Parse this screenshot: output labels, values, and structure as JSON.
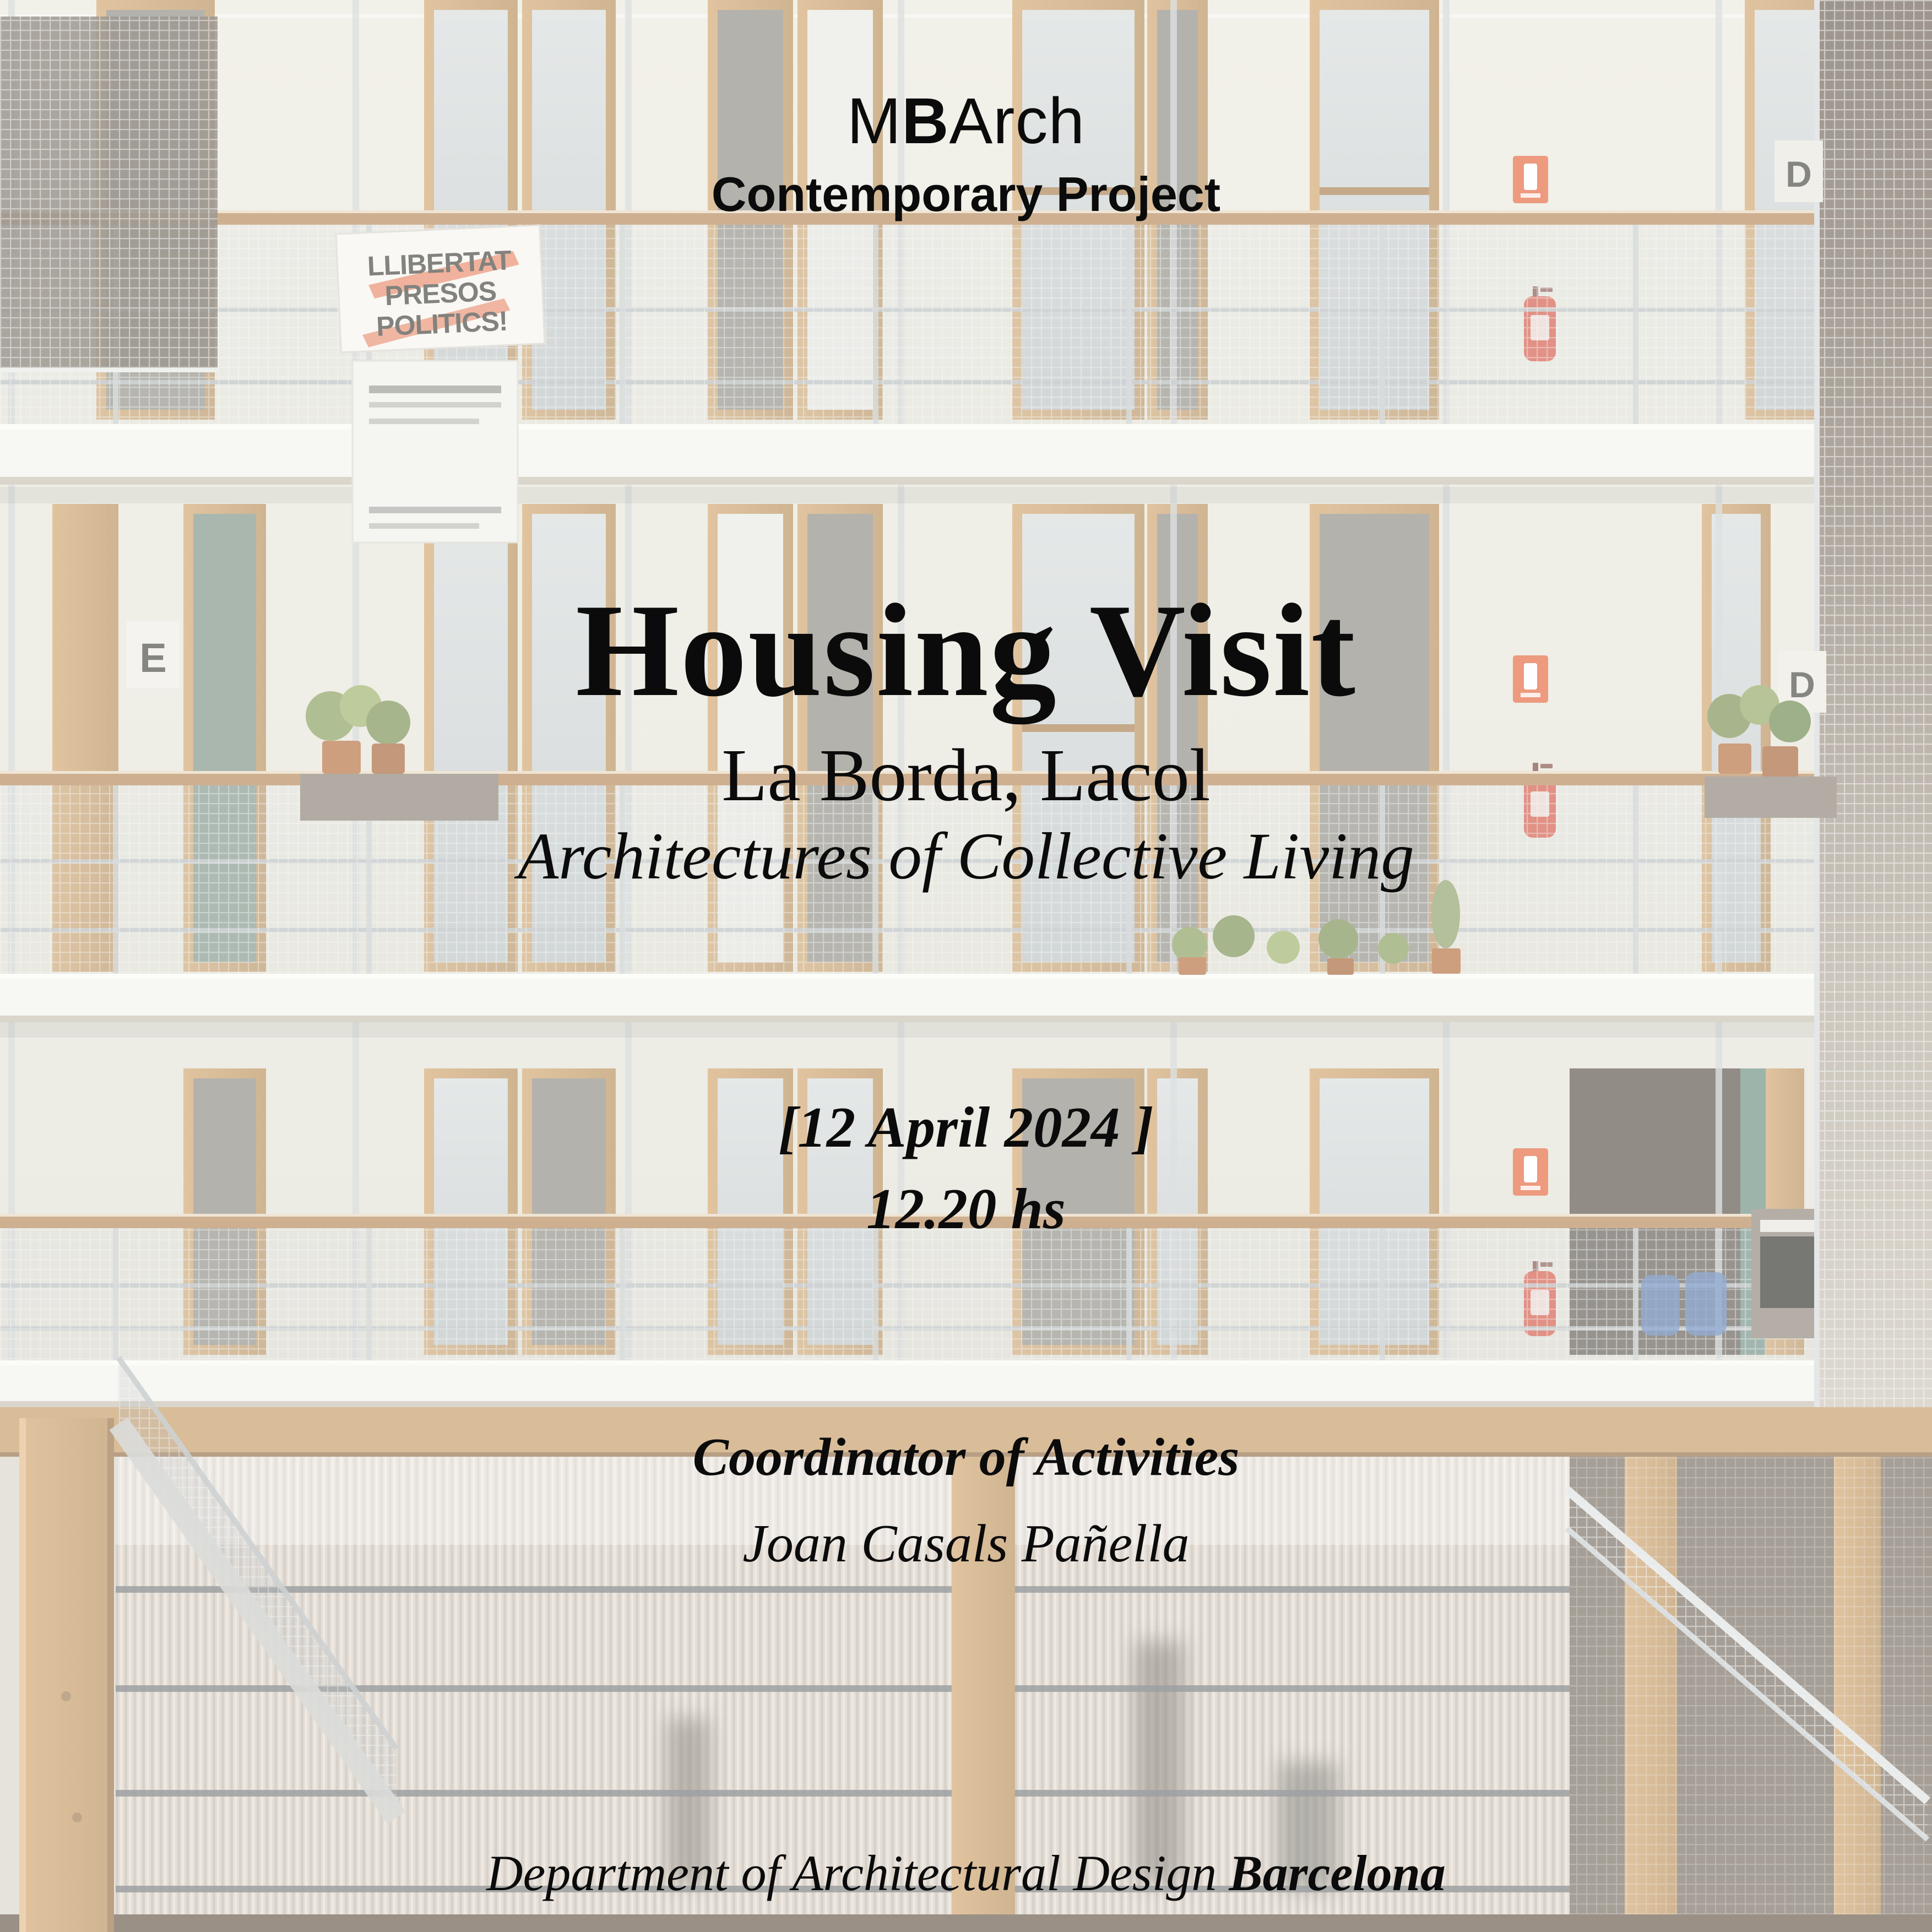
{
  "poster": {
    "program": {
      "part1": "M",
      "part2": "B",
      "part3": "Arch"
    },
    "program_line": "Contemporary Project",
    "title": "Housing Visit",
    "subtitle": "La Borda, Lacol",
    "tagline": "Architectures of Collective Living",
    "date": "[12 April 2024 ]",
    "time": "12.20 hs",
    "coordinator_label": "Coordinator of Activities",
    "coordinator_name": "Joan Casals Pañella",
    "footer_department": "Department of Architectural Design",
    "footer_city": "Barcelona"
  },
  "photo": {
    "subject": "courtyard-of-la-borda-cooperative-housing",
    "banner": {
      "lines": [
        "LLIBERTAT",
        "PRESOS",
        "POLITICS!"
      ]
    },
    "signs": {
      "stair_left": "E",
      "stair_right": "D",
      "stair_right_top": "D"
    },
    "colors": {
      "wall": "#e4e4da",
      "wood": "#c89e68",
      "slab": "#f2f2ec",
      "steel": "#c3c8ca",
      "glass": "#ccd3d4",
      "accent_orange": "#e4693f",
      "extinguisher_red": "#d9503c",
      "mesh_backdrop": "#7c6f62",
      "polycarbonate": "#d3cabf",
      "ground": "#6b5a4a"
    }
  }
}
